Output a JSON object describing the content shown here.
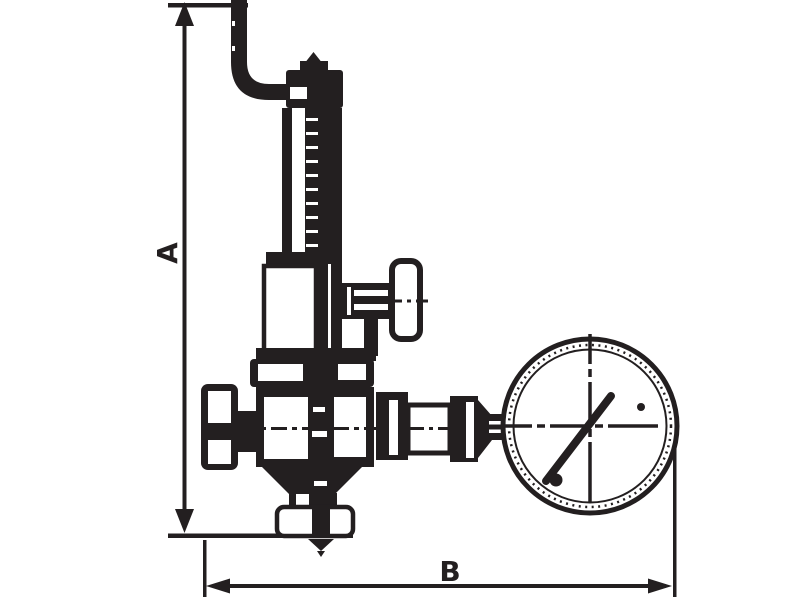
{
  "diagram": {
    "ink_color": "#231f20",
    "background_color": "#ffffff",
    "dim_a": {
      "label": "A",
      "orientation": "vertical"
    },
    "dim_b": {
      "label": "B",
      "orientation": "horizontal"
    },
    "parts": [
      "exhaust-pipe",
      "adjustment-cap",
      "spring-bonnet",
      "drain-tee-handle",
      "spring-chamber",
      "valve-body",
      "inlet-cap-nut",
      "bottom-outlet-flange",
      "gauge-connection-fittings",
      "pressure-gauge"
    ]
  }
}
